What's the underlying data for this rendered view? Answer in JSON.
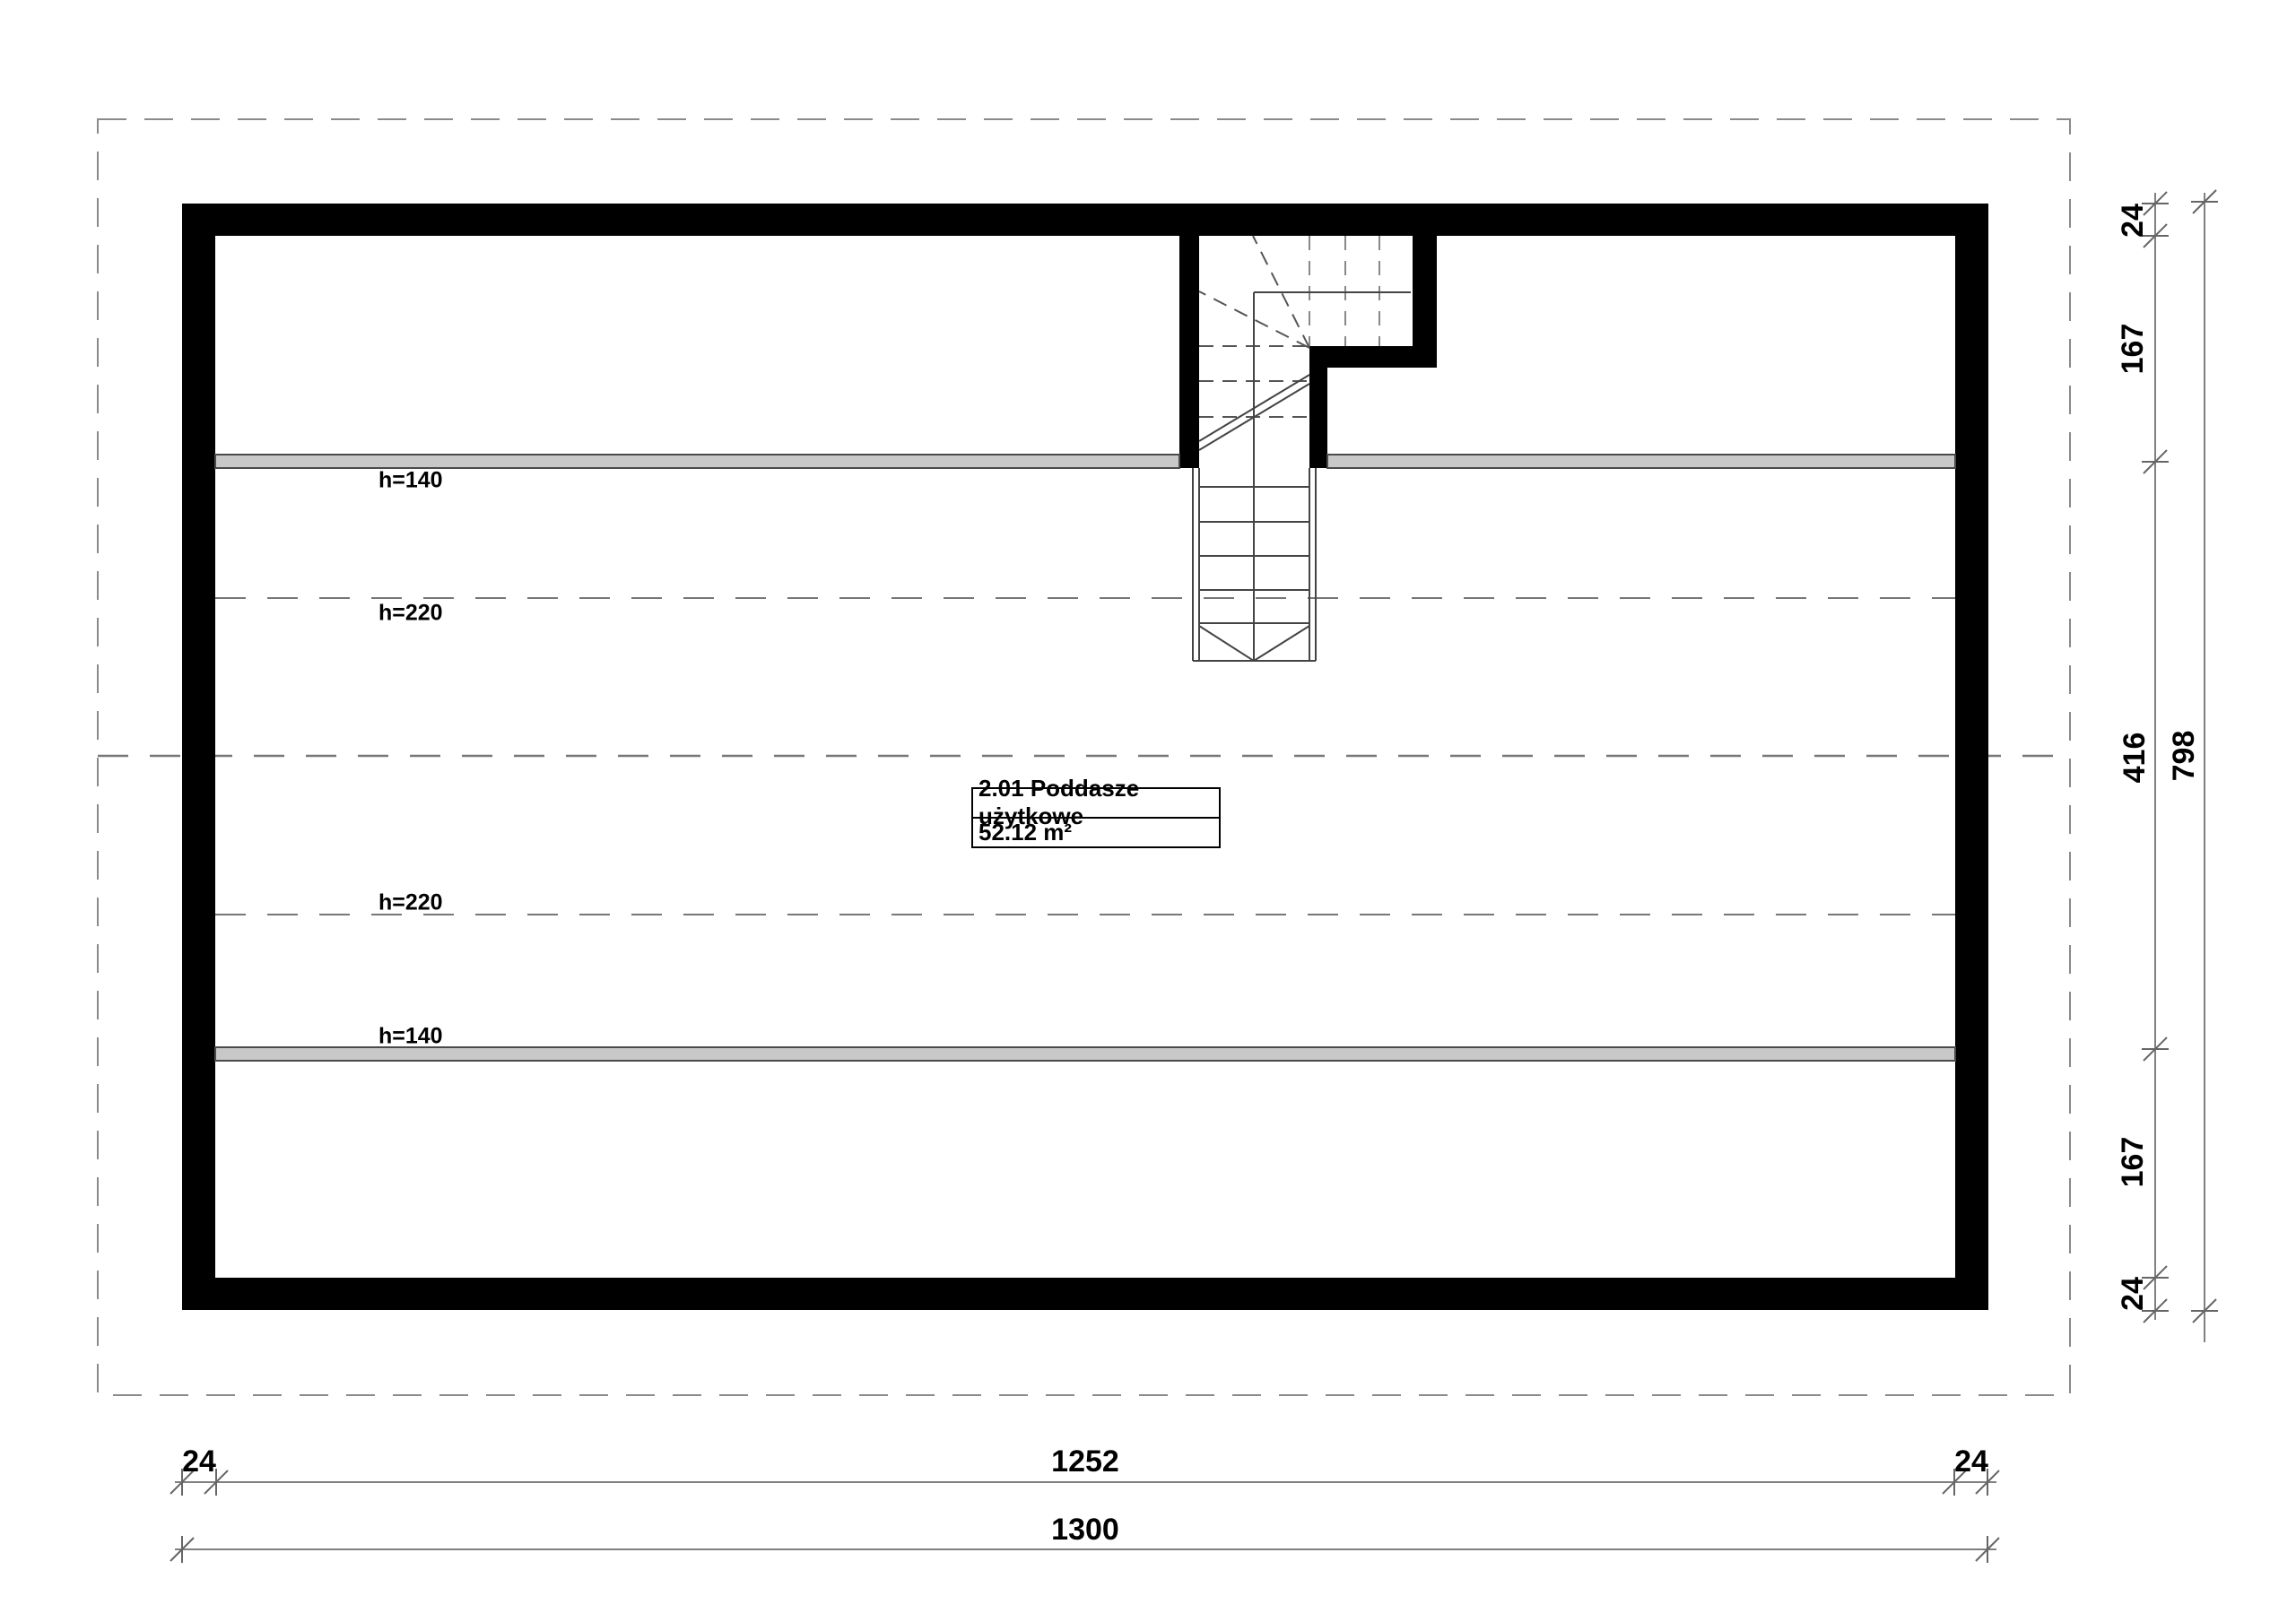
{
  "room": {
    "id_name": "2.01 Poddasze użytkowe",
    "area": "52.12 m²"
  },
  "height_labels": {
    "top_h140": "h=140",
    "top_h220": "h=220",
    "bottom_h220": "h=220",
    "bottom_h140": "h=140"
  },
  "dims": {
    "bottom_inner": {
      "left_wall": "24",
      "interior": "1252",
      "right_wall": "24"
    },
    "bottom_total": "1300",
    "right_inner": {
      "top_wall": "24",
      "top_zone": "167",
      "middle_zone": "416",
      "bottom_zone": "167",
      "bottom_wall": "24"
    },
    "right_total": "798"
  },
  "colors": {
    "wall": "#000000",
    "knee_wall_band": "#c8c8c8",
    "dashed_lines": "#777777",
    "dimension_lines": "#808080",
    "text": "#000000"
  }
}
